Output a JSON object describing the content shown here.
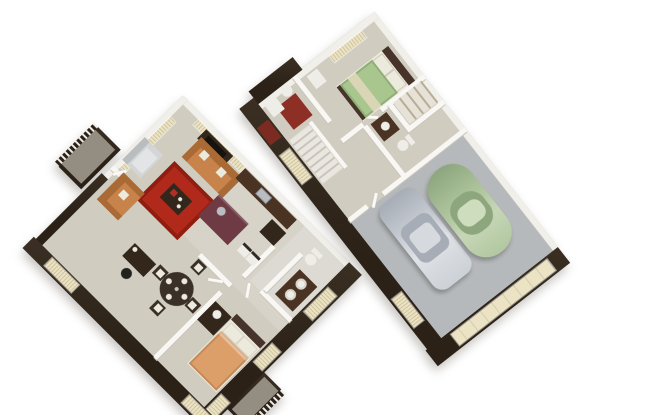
{
  "scene": {
    "description": "3D isometric rendering of two townhouse floor plans on a white background",
    "plans": [
      {
        "name": "upper-floor-plan",
        "rooms": [
          "living-room",
          "kitchen",
          "dining-area",
          "desk-nook",
          "hallway",
          "bathroom",
          "bedroom",
          "balcony",
          "porch"
        ],
        "furniture": [
          "area-rug",
          "sofa",
          "loveseat",
          "armchair",
          "coffee-table",
          "tv-stand",
          "side-table",
          "kitchen-cabinets",
          "kitchen-island",
          "pantry-cabinet",
          "washer",
          "dryer",
          "dining-table",
          "dining-chairs",
          "desk",
          "desk-chair",
          "double-vanity",
          "toilet",
          "bed",
          "dresser",
          "table-lamp",
          "balcony-railing",
          "porch-railing"
        ]
      },
      {
        "name": "ground-floor-plan",
        "rooms": [
          "bedroom",
          "closet",
          "bathroom",
          "hallway",
          "staircase",
          "entry",
          "garage"
        ],
        "furniture": [
          "bed",
          "nightstand",
          "closet-shelves",
          "vanity",
          "toilet",
          "bath-mat",
          "sedan-car",
          "compact-car",
          "garage-door",
          "entry-door",
          "stairs"
        ]
      }
    ]
  },
  "colors": {
    "bg": "#ffffff",
    "shadow": "rgba(70,60,45,0.30)",
    "wall-dark": "#2b2117",
    "wall-dark-light": "#3a2f22",
    "wall-white": "#f1efe9",
    "wall-inner": "#f8f7f4",
    "wall-shadow": "#c9c5bb",
    "floor-carpet": "#d1ccc0",
    "floor-kitchen": "#d7d3c8",
    "floor-bath": "#dcdad3",
    "floor-garage": "#b6b9bb",
    "balcony-floor": "#948d81",
    "rug-red": "#b1291b",
    "rug-red-dark": "#8f1e10",
    "sofa": "#c8834a",
    "sofa-dark": "#a96a35",
    "armchair": "#d3d5d7",
    "armchair-dark": "#b9bdc0",
    "wood-dark": "#33261a",
    "wood-mid": "#4a3322",
    "island": "#6e3a44",
    "steel": "#b9bdc2",
    "white-furn": "#efede7",
    "table-dark": "#3a3028",
    "bed-orange": "#dd9f6a",
    "bed-green": "#a8c68e",
    "blanket-cream": "#d9d5b5",
    "pillow": "#ece9dd",
    "headboard": "#46342a",
    "window-cream": "#ebe3c4",
    "blind-line": "#cfc49d",
    "door-red": "#7c2b22",
    "mat-red": "#8e2f26",
    "car-silver": "#ccd1d7",
    "car-silver-dark": "#a7adb6",
    "car-green": "#b2c8a1",
    "car-green-dark": "#8da67e",
    "stair-light": "#eae7e0",
    "stair-dark": "#c9c5bb",
    "screen-black": "#15120f"
  }
}
